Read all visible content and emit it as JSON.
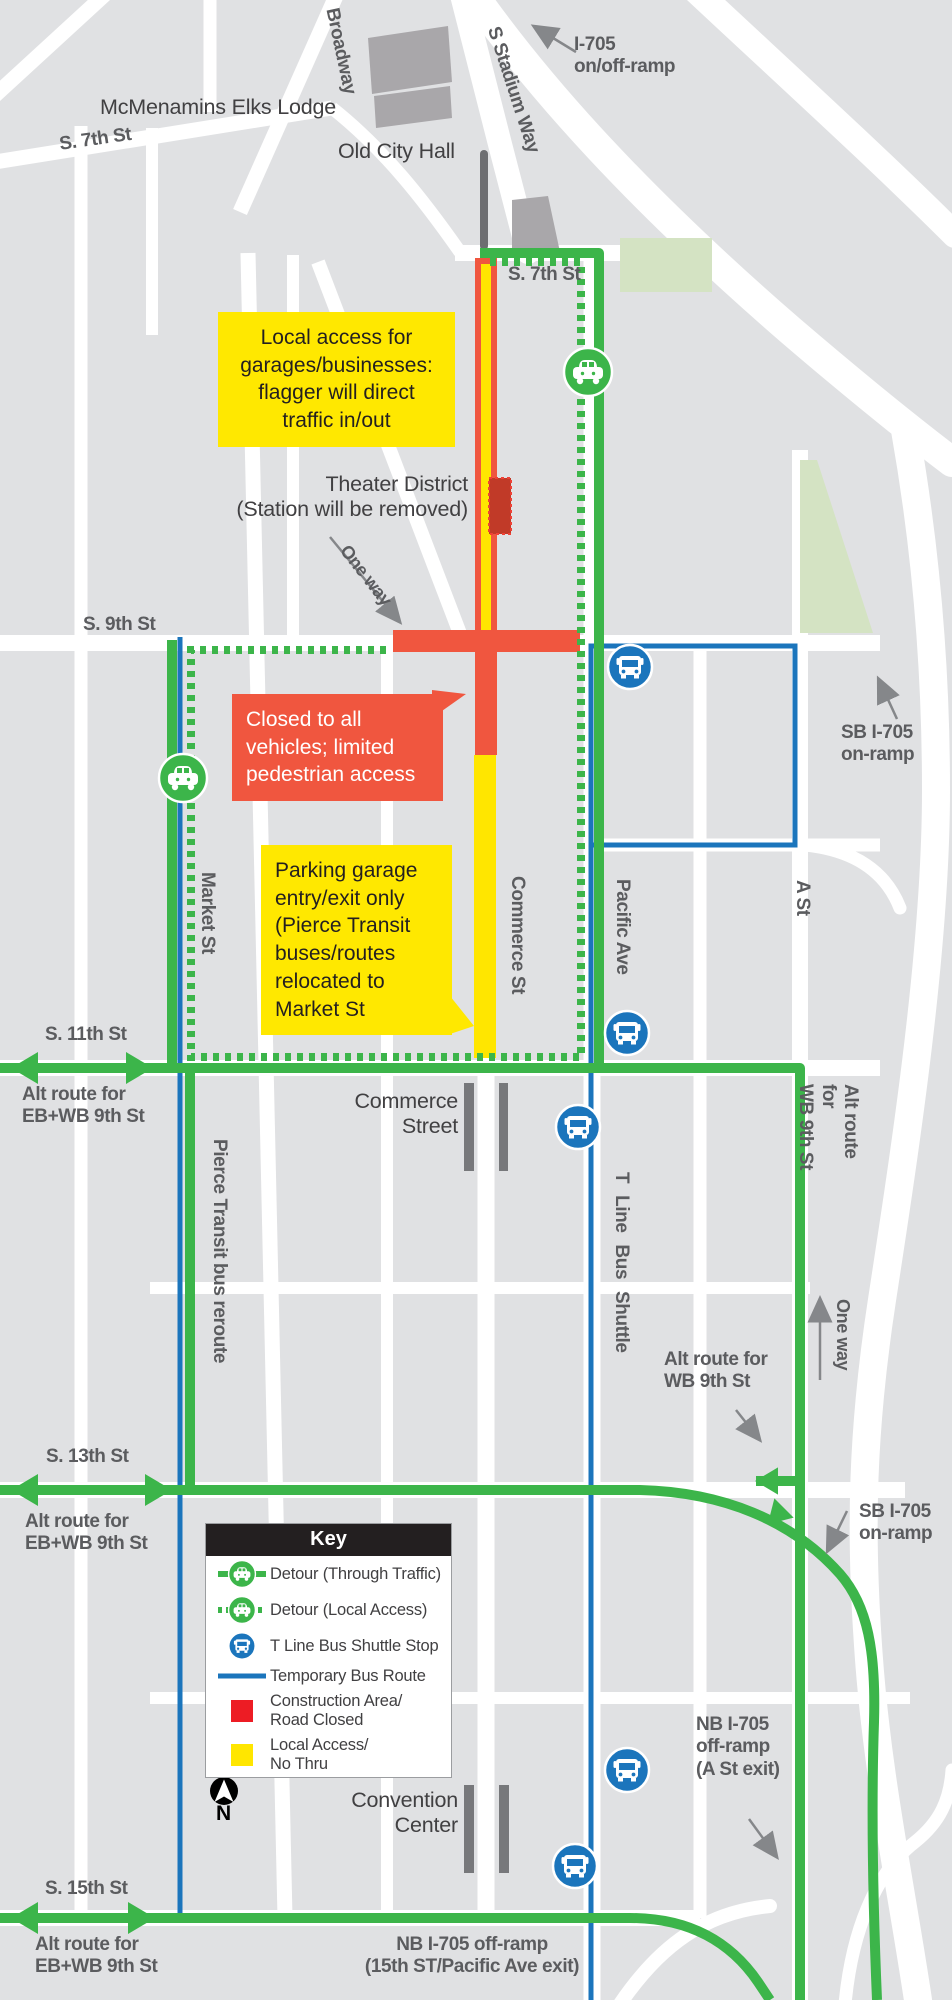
{
  "colors": {
    "detour_green": "#3cb54a",
    "bus_blue": "#1b75bc",
    "construction_red": "#f0563f",
    "legend_red": "#ed1c24",
    "access_yellow": "#ffe600",
    "callout_yellow": "#ffe800",
    "park_green": "#d4e3c3",
    "road_white": "#ffffff",
    "block_gray": "#e0e1e3",
    "building_gray": "#a9a7aa",
    "label_gray": "#5b5c5f",
    "text_dark": "#414042"
  },
  "labels": {
    "mcmenamins": "McMenamins Elks Lodge",
    "s7th_a": "S. 7th St",
    "broadway": "Broadway",
    "stadium_way": "S Stadium Way",
    "i705_ramp": "I-705\non/off-ramp",
    "old_city_hall": "Old City Hall",
    "s7th_b": "S. 7th St",
    "theater": "Theater District\n(Station will be removed)",
    "one_way_a": "One way",
    "s9th": "S. 9th St",
    "sb_onramp_a": "SB I-705\non-ramp",
    "market": "Market St",
    "commerce": "Commerce St",
    "pacific": "Pacific Ave",
    "a_st": "A St",
    "s11th": "S. 11th St",
    "alt_eb_a": "Alt route for\nEB+WB 9th St",
    "pierce": "Pierce Transit bus reroute",
    "commerce_street": "Commerce\nStreet",
    "t_line": "T Line Bus Shuttle",
    "alt_wb_a": "Alt route for\nWB 9th St",
    "one_way_b": "One way",
    "alt_wb_b": "Alt route for\nWB 9th St",
    "s13th": "S. 13th St",
    "alt_eb_b": "Alt route for\nEB+WB 9th St",
    "sb_onramp_b": "SB I-705\non-ramp",
    "nb_offramp_a": "NB I-705\noff-ramp\n(A St exit)",
    "convention": "Convention\nCenter",
    "s15th": "S. 15th St",
    "alt_eb_c": "Alt route for\nEB+WB 9th St",
    "nb_offramp_b": "NB I-705 off-ramp\n(15th ST/Pacific Ave exit)"
  },
  "callouts": {
    "local_access": "Local access for\ngarages/businesses:\nflagger will direct\ntraffic in/out",
    "closed": "Closed to all\nvehicles; limited\npedestrian access",
    "parking": "Parking garage\nentry/exit only\n(Pierce Transit\nbuses/routes\nrelocated to\nMarket St"
  },
  "key": {
    "title": "Key",
    "items": [
      {
        "icon": "detour-through-icon",
        "label": "Detour (Through Traffic)"
      },
      {
        "icon": "detour-local-icon",
        "label": "Detour (Local Access)"
      },
      {
        "icon": "bus-stop-icon",
        "label": "T Line Bus Shuttle Stop"
      },
      {
        "icon": "temp-bus-route-icon",
        "label": "Temporary Bus Route"
      },
      {
        "icon": "construction-icon",
        "label": "Construction Area/\nRoad Closed"
      },
      {
        "icon": "local-access-icon",
        "label": "Local Access/\nNo Thru"
      }
    ]
  },
  "compass": {
    "n": "N"
  }
}
